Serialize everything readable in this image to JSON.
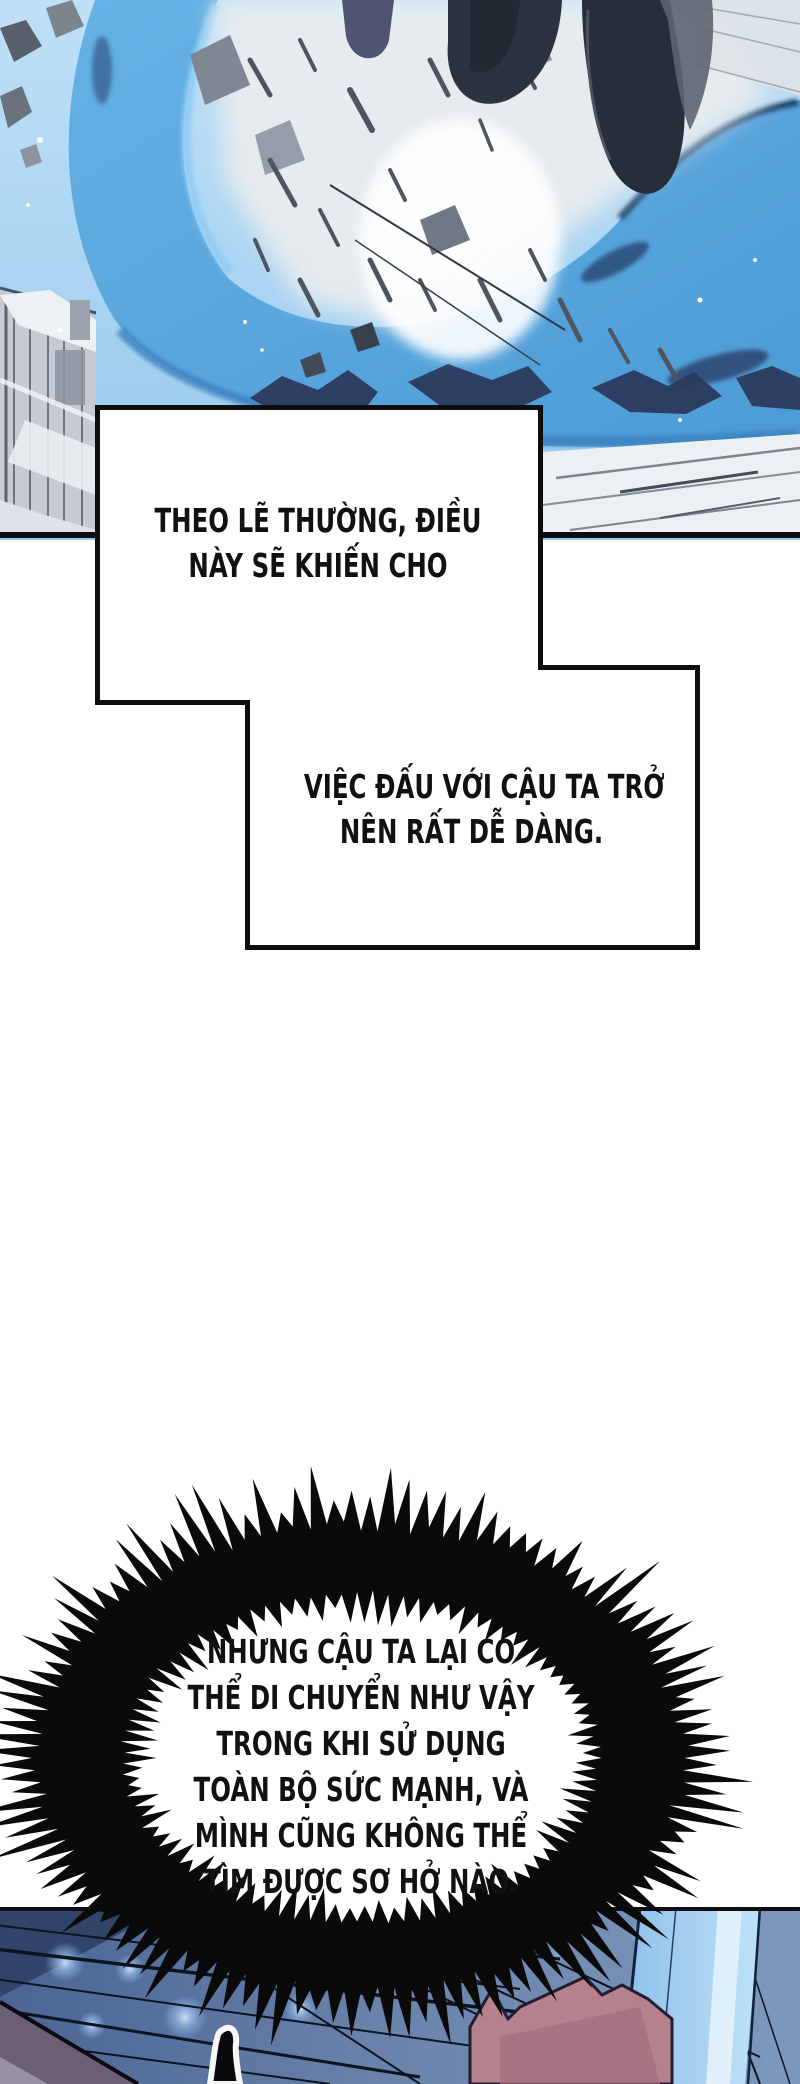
{
  "page": {
    "width": 800,
    "height": 2084,
    "background_color": "#ffffff"
  },
  "panels": {
    "top_art": {
      "label": "action scene with blue shockwave swoosh, debris cloud and dark leaping figure",
      "sky_blue": "#aed6f2",
      "swoosh_blue": "#57a6dc",
      "swoosh_highlight": "#93cdf2",
      "swoosh_shadow": "#1d3a60",
      "debris_grey": "#e9ecef",
      "silhouette_dark": "#2c323e",
      "edge_line": "#0b0d11"
    },
    "bottom_art": {
      "label": "dusk street scene with power lines, bokeh lights and glass building",
      "sky_slate": "#6b84ab",
      "sky_dark_corner": "#31456b",
      "building_glass_blue": "#bfe2f8",
      "bokeh_blue": "#b8d8f8",
      "pink_structure": "#b4818c",
      "roof_mauve": "#6b5f72",
      "line_dark": "#0d1320"
    }
  },
  "speech_boxes": {
    "fill": "#ffffff",
    "border": "#0d0d0d",
    "box1": {
      "lines": [
        "THEO LẼ THƯỜNG, ĐIỀU",
        "NÀY SẼ KHIẾN CHO"
      ]
    },
    "box2": {
      "lines": [
        "VIỆC ĐẤU VỚI CẬU TA TRỞ",
        "NÊN RẤT DỄ DÀNG."
      ]
    }
  },
  "burst_bubble": {
    "fill": "#0a0a0a",
    "interior": "#ffffff",
    "lines": [
      "NHƯNG CẬU TA LẠI CÓ",
      "THỂ DI CHUYỂN NHƯ VẬY",
      "TRONG KHI SỬ DỤNG",
      "TOÀN BỘ SỨC MẠNH, VÀ",
      "MÌNH CŨNG KHÔNG THỂ",
      "TÌM ĐƯỢC SƠ HỞ NÀO."
    ]
  },
  "text_color": "#111111"
}
